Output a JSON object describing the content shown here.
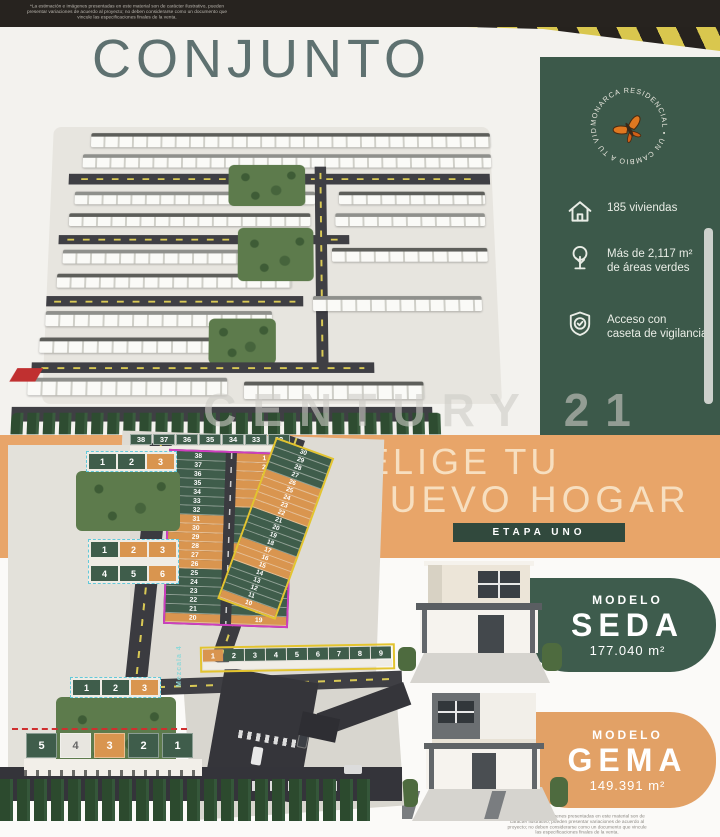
{
  "disclaimer": "*La estimación e imágenes presentadas en este material son de carácter ilustrativo, pueden presentar variaciones de acuerdo al proyecto; no deben considerarse como un documento que vincule las especificaciones finales de la venta.",
  "conjunto": {
    "title": "CONJUNTO",
    "watermark": "CENTURY 21"
  },
  "info_panel": {
    "badge_text": "MONARCA RESIDENCIAL • UN CAMBIO A TU VIDA •",
    "stats": [
      {
        "icon": "house-icon",
        "label": "185 viviendas"
      },
      {
        "icon": "tree-icon",
        "label": "Más de 2,117 m²\nde áreas verdes"
      },
      {
        "icon": "shield-icon",
        "label": "Acceso con\ncaseta de vigilancia"
      }
    ]
  },
  "hero": {
    "line1": "ELIGE TU",
    "line2": "NUEVO HOGAR",
    "stage": "ETAPA UNO"
  },
  "models": [
    {
      "label": "MODELO",
      "name": "SEDA",
      "area": "177.040 m²"
    },
    {
      "label": "MODELO",
      "name": "GEMA",
      "area": "149.391 m²"
    }
  ],
  "site_plan": {
    "street_label": "Mezcala 4",
    "top_row": [
      {
        "n": "38",
        "c": "g"
      },
      {
        "n": "37",
        "c": "g"
      },
      {
        "n": "36",
        "c": "g"
      },
      {
        "n": "35",
        "c": "g"
      },
      {
        "n": "34",
        "c": "g"
      },
      {
        "n": "33",
        "c": "g"
      },
      {
        "n": "32",
        "c": "g"
      }
    ],
    "central_left": [
      {
        "n": "38",
        "c": "g"
      },
      {
        "n": "37",
        "c": "g"
      },
      {
        "n": "36",
        "c": "g"
      },
      {
        "n": "35",
        "c": "g"
      },
      {
        "n": "34",
        "c": "g"
      },
      {
        "n": "33",
        "c": "g"
      },
      {
        "n": "32",
        "c": "g"
      },
      {
        "n": "31",
        "c": "o"
      },
      {
        "n": "30",
        "c": "o"
      },
      {
        "n": "29",
        "c": "o"
      },
      {
        "n": "28",
        "c": "o"
      },
      {
        "n": "27",
        "c": "o"
      },
      {
        "n": "26",
        "c": "o"
      },
      {
        "n": "25",
        "c": "g"
      },
      {
        "n": "24",
        "c": "g"
      },
      {
        "n": "23",
        "c": "g"
      },
      {
        "n": "22",
        "c": "g"
      },
      {
        "n": "21",
        "c": "g"
      },
      {
        "n": "20",
        "c": "o"
      }
    ],
    "central_right": [
      {
        "n": "1",
        "c": "o"
      },
      {
        "n": "2",
        "c": "o"
      },
      {
        "n": "3",
        "c": "o"
      },
      {
        "n": "4",
        "c": "o"
      },
      {
        "n": "5",
        "c": "o"
      },
      {
        "n": "6",
        "c": "o"
      },
      {
        "n": "7",
        "c": "g"
      },
      {
        "n": "8",
        "c": "g"
      },
      {
        "n": "9",
        "c": "g"
      },
      {
        "n": "10",
        "c": "g"
      },
      {
        "n": "11",
        "c": "o"
      },
      {
        "n": "12",
        "c": "o"
      },
      {
        "n": "13",
        "c": "o"
      },
      {
        "n": "14",
        "c": "g"
      },
      {
        "n": "15",
        "c": "g"
      },
      {
        "n": "16",
        "c": "g"
      },
      {
        "n": "17",
        "c": "g"
      },
      {
        "n": "18",
        "c": "g"
      },
      {
        "n": "19",
        "c": "o"
      }
    ],
    "east_col": [
      {
        "n": "30",
        "c": "g"
      },
      {
        "n": "29",
        "c": "g"
      },
      {
        "n": "28",
        "c": "g"
      },
      {
        "n": "27",
        "c": "g"
      },
      {
        "n": "26",
        "c": "o"
      },
      {
        "n": "25",
        "c": "o"
      },
      {
        "n": "24",
        "c": "o"
      },
      {
        "n": "23",
        "c": "o"
      },
      {
        "n": "22",
        "c": "o"
      },
      {
        "n": "21",
        "c": "g"
      },
      {
        "n": "20",
        "c": "g"
      },
      {
        "n": "19",
        "c": "g"
      },
      {
        "n": "18",
        "c": "g"
      },
      {
        "n": "17",
        "c": "o"
      },
      {
        "n": "16",
        "c": "o"
      },
      {
        "n": "15",
        "c": "o"
      },
      {
        "n": "14",
        "c": "g"
      },
      {
        "n": "13",
        "c": "g"
      },
      {
        "n": "12",
        "c": "g"
      },
      {
        "n": "11",
        "c": "g"
      },
      {
        "n": "10",
        "c": "o"
      }
    ],
    "bottom_row": [
      {
        "n": "1",
        "c": "o"
      },
      {
        "n": "2",
        "c": "g"
      },
      {
        "n": "3",
        "c": "g"
      },
      {
        "n": "4",
        "c": "g"
      },
      {
        "n": "5",
        "c": "g"
      },
      {
        "n": "6",
        "c": "g"
      },
      {
        "n": "7",
        "c": "g"
      },
      {
        "n": "8",
        "c": "g"
      },
      {
        "n": "9",
        "c": "g"
      }
    ],
    "block_a": [
      {
        "n": "1",
        "c": "g"
      },
      {
        "n": "2",
        "c": "g"
      },
      {
        "n": "3",
        "c": "o"
      }
    ],
    "block_b": [
      {
        "n": "1",
        "c": "g"
      },
      {
        "n": "2",
        "c": "o"
      },
      {
        "n": "3",
        "c": "o"
      },
      {
        "n": "4",
        "c": "g"
      },
      {
        "n": "5",
        "c": "g"
      },
      {
        "n": "6",
        "c": "o"
      }
    ],
    "block_c": [
      {
        "n": "1",
        "c": "g"
      },
      {
        "n": "2",
        "c": "g"
      },
      {
        "n": "3",
        "c": "o"
      }
    ],
    "front_row": [
      {
        "n": "5",
        "c": "g"
      },
      {
        "n": "4",
        "c": "w"
      },
      {
        "n": "3",
        "c": "o"
      },
      {
        "n": "2",
        "c": "g"
      },
      {
        "n": "1",
        "c": "g"
      }
    ]
  }
}
